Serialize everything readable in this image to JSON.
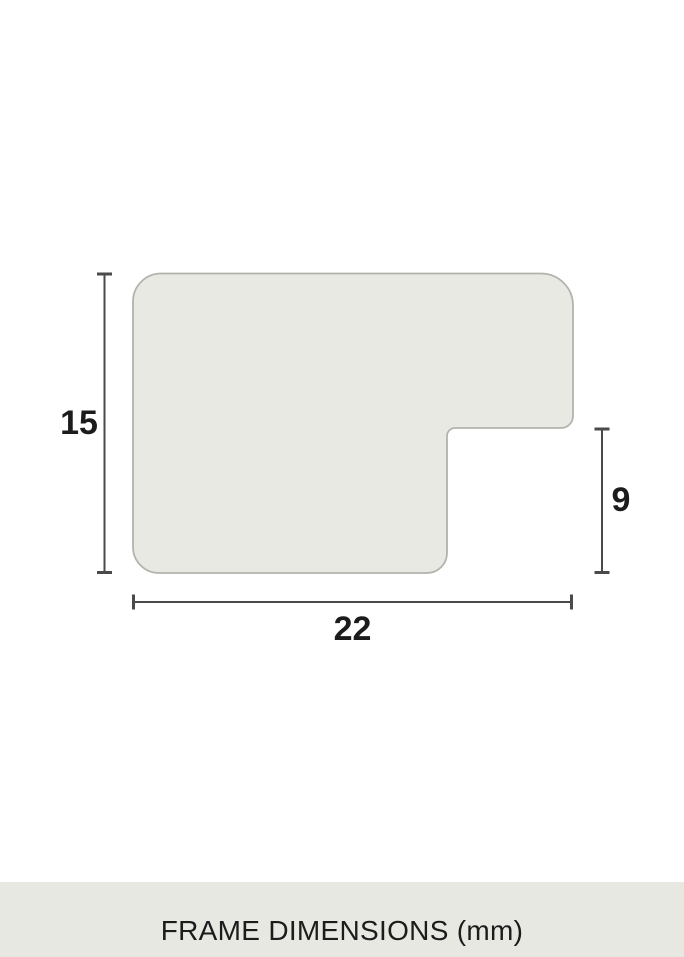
{
  "colors": {
    "page_bg": "#ffffff",
    "profile_fill": "#e9e9e4",
    "profile_stroke": "#b3b3ad",
    "dimension_color": "#4a4a4a",
    "label_color": "#1c1c1c",
    "footer_bg": "#e8e8e2",
    "footer_text": "#1c1c1c"
  },
  "diagram": {
    "type": "frame-moulding-cross-section",
    "height_dimension": "15",
    "width_dimension": "22",
    "rabbet_dimension": "9"
  },
  "footer": {
    "caption": "FRAME DIMENSIONS (mm)"
  }
}
